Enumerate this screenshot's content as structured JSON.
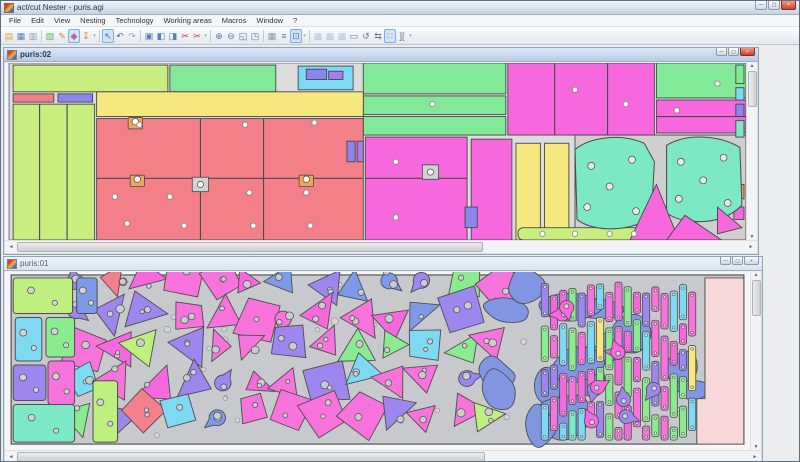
{
  "app": {
    "title": "act/cut Nester - puris.agi"
  },
  "captions": {
    "min": "—",
    "max": "▢",
    "close": "×"
  },
  "scroll": {
    "up": "▲",
    "down": "▼",
    "left": "◄",
    "right": "►"
  },
  "menu": {
    "items": [
      "File",
      "Edit",
      "View",
      "Nesting",
      "Technology",
      "Working areas",
      "Macros",
      "Window",
      "?"
    ]
  },
  "toolbar": {
    "items": [
      {
        "t": "b",
        "n": "open",
        "g": "▤",
        "c": "#d9a33c"
      },
      {
        "t": "b",
        "n": "save",
        "g": "▦",
        "c": "#5b7fb4"
      },
      {
        "t": "b",
        "n": "print",
        "g": "▥",
        "c": "#8d98a5"
      },
      {
        "t": "s"
      },
      {
        "t": "b",
        "n": "new-sheet",
        "g": "▧",
        "c": "#58b65c"
      },
      {
        "t": "b",
        "n": "edit-sheet",
        "g": "✎",
        "c": "#d98a3c"
      },
      {
        "t": "b",
        "n": "erase-tool",
        "g": "◆",
        "c": "#d0569a",
        "st": "sel"
      },
      {
        "t": "b",
        "n": "punch-tool",
        "g": "↧",
        "c": "#c8872e"
      },
      {
        "t": "g"
      },
      {
        "t": "s"
      },
      {
        "t": "b",
        "n": "select-pointer",
        "g": "↖",
        "c": "#3d6eb4",
        "st": "sel"
      },
      {
        "t": "b",
        "n": "undo",
        "g": "↶",
        "c": "#3d6eb4"
      },
      {
        "t": "b",
        "n": "redo",
        "g": "↷",
        "c": "#9aa3ad"
      },
      {
        "t": "s"
      },
      {
        "t": "b",
        "n": "copy",
        "g": "▣",
        "c": "#5b7fb4"
      },
      {
        "t": "b",
        "n": "paste",
        "g": "◧",
        "c": "#5b7fb4"
      },
      {
        "t": "b",
        "n": "paste-special",
        "g": "◨",
        "c": "#5b7fb4"
      },
      {
        "t": "b",
        "n": "cut",
        "g": "✂",
        "c": "#cc3c34"
      },
      {
        "t": "b",
        "n": "cut-multi",
        "g": "✂",
        "c": "#cc3c34"
      },
      {
        "t": "g"
      },
      {
        "t": "s"
      },
      {
        "t": "b",
        "n": "zoom-in",
        "g": "⊕",
        "c": "#4a7ab0"
      },
      {
        "t": "b",
        "n": "zoom-out",
        "g": "⊖",
        "c": "#4a7ab0"
      },
      {
        "t": "b",
        "n": "zoom-window",
        "g": "◱",
        "c": "#4a7ab0"
      },
      {
        "t": "b",
        "n": "zoom-all",
        "g": "◳",
        "c": "#4a7ab0"
      },
      {
        "t": "s"
      },
      {
        "t": "b",
        "n": "grid",
        "g": "▦",
        "c": "#8d98a5"
      },
      {
        "t": "b",
        "n": "sort-parts",
        "g": "≡",
        "c": "#4a7ab0"
      },
      {
        "t": "b",
        "n": "origin-toggle",
        "g": "⊡",
        "c": "#4a7ab0",
        "st": "sel"
      },
      {
        "t": "g"
      },
      {
        "t": "s"
      },
      {
        "t": "b",
        "n": "nest-auto",
        "g": "▩",
        "c": "#4a7ab0",
        "st": "dis"
      },
      {
        "t": "b",
        "n": "nest-block",
        "g": "▩",
        "c": "#4a7ab0",
        "st": "dis"
      },
      {
        "t": "b",
        "n": "nest-fill",
        "g": "▩",
        "c": "#4a7ab0",
        "st": "dis"
      },
      {
        "t": "b",
        "n": "sheet-outline",
        "g": "▭",
        "c": "#6a7685"
      },
      {
        "t": "b",
        "n": "rotate-part",
        "g": "↺",
        "c": "#6a7685"
      },
      {
        "t": "b",
        "n": "flip-part",
        "g": "⇆",
        "c": "#6a7685"
      },
      {
        "t": "b",
        "n": "pair-parts",
        "g": "∷",
        "c": "#e0742c",
        "st": "sel"
      },
      {
        "t": "b",
        "n": "gauge",
        "g": "][",
        "c": "#6a7685"
      },
      {
        "t": "g"
      }
    ]
  },
  "mdi": {
    "windows": [
      {
        "title": "puris:02",
        "active": true
      },
      {
        "title": "puris:01",
        "active": false
      }
    ]
  },
  "win1": {
    "palette": {
      "LG": "#c9ee80",
      "GN": "#82e998",
      "YL": "#f6e87e",
      "SM": "#f37f89",
      "MG": "#f767de",
      "CY": "#7edaf2",
      "BL": "#8a86f0",
      "AQ": "#7ce9c4",
      "OR": "#efa45a",
      "VT": "#a77df0",
      "GY": "#cfcfcf"
    },
    "sheet": [
      4,
      0,
      724,
      172
    ],
    "rects": [
      [
        8,
        2,
        152,
        26,
        "LG"
      ],
      [
        162,
        2,
        104,
        26,
        "GN"
      ],
      [
        288,
        3,
        54,
        23,
        "CY"
      ],
      [
        352,
        0,
        140,
        30,
        "GN"
      ],
      [
        352,
        32,
        140,
        18,
        "GN"
      ],
      [
        352,
        52,
        140,
        18,
        "GN"
      ],
      [
        494,
        0,
        144,
        70,
        "MG"
      ],
      [
        640,
        0,
        88,
        34,
        "GN"
      ],
      [
        640,
        36,
        88,
        32,
        "MG"
      ],
      [
        8,
        30,
        40,
        8,
        "SM"
      ],
      [
        52,
        30,
        34,
        8,
        "BL"
      ],
      [
        8,
        40,
        80,
        132,
        "LG"
      ],
      [
        90,
        28,
        262,
        24,
        "YL"
      ],
      [
        90,
        54,
        262,
        118,
        "SM"
      ],
      [
        354,
        72,
        100,
        100,
        "MG"
      ],
      [
        458,
        74,
        40,
        98,
        "MG"
      ],
      [
        502,
        78,
        24,
        94,
        "YL"
      ],
      [
        530,
        78,
        24,
        94,
        "YL"
      ],
      [
        560,
        70,
        168,
        102,
        "GY"
      ],
      [
        296,
        6,
        20,
        10,
        "BL"
      ],
      [
        318,
        8,
        14,
        8,
        "VT"
      ],
      [
        336,
        76,
        8,
        20,
        "BL"
      ],
      [
        346,
        76,
        6,
        20,
        "VT"
      ],
      [
        452,
        140,
        12,
        20,
        "BL"
      ],
      [
        718,
        2,
        8,
        18,
        "GN"
      ],
      [
        718,
        24,
        8,
        12,
        "CY"
      ],
      [
        718,
        40,
        8,
        12,
        "BL"
      ],
      [
        718,
        56,
        8,
        16,
        "AQ"
      ],
      [
        718,
        118,
        8,
        14,
        "OR"
      ],
      [
        716,
        140,
        10,
        12,
        "MG"
      ]
    ],
    "bar": [
      504,
      160,
      130,
      12,
      "LG"
    ],
    "lines": [
      [
        34,
        40,
        34,
        172
      ],
      [
        61,
        40,
        61,
        172
      ],
      [
        192,
        54,
        192,
        172
      ],
      [
        254,
        54,
        254,
        172
      ],
      [
        90,
        112,
        352,
        112
      ],
      [
        354,
        112,
        454,
        112
      ],
      [
        540,
        0,
        540,
        70
      ],
      [
        592,
        0,
        592,
        70
      ],
      [
        640,
        52,
        728,
        52
      ]
    ],
    "circles": [
      [
        132,
        60
      ],
      [
        236,
        60
      ],
      [
        304,
        58
      ],
      [
        108,
        130
      ],
      [
        162,
        130
      ],
      [
        240,
        126
      ],
      [
        296,
        126
      ],
      [
        120,
        156
      ],
      [
        176,
        158
      ],
      [
        244,
        158
      ],
      [
        300,
        158
      ],
      [
        384,
        96
      ],
      [
        384,
        150
      ],
      [
        420,
        40
      ],
      [
        560,
        26
      ],
      [
        610,
        40
      ],
      [
        660,
        46
      ],
      [
        700,
        20
      ],
      [
        528,
        166
      ],
      [
        560,
        166
      ],
      [
        594,
        166
      ],
      [
        618,
        166
      ]
    ],
    "clamps": [
      [
        128,
        58
      ],
      [
        130,
        114
      ],
      [
        296,
        114
      ]
    ],
    "plates": [
      [
        192,
        118
      ],
      [
        418,
        106
      ]
    ],
    "blobs": [
      {
        "d": "M560,84 C575,72 605,68 628,78 L638,96 L635,150 C615,164 578,165 562,152 Z",
        "holes": [
          [
            576,
            100
          ],
          [
            616,
            94
          ],
          [
            572,
            140
          ],
          [
            620,
            144
          ],
          [
            594,
            120
          ]
        ]
      },
      {
        "d": "M650,80 C670,68 702,70 722,82 L724,138 C706,158 668,158 650,146 Z",
        "holes": [
          [
            664,
            96
          ],
          [
            706,
            92
          ],
          [
            662,
            132
          ],
          [
            710,
            136
          ],
          [
            686,
            114
          ]
        ]
      }
    ],
    "wedges": [
      [
        640,
        118,
        662,
        172,
        614,
        172
      ],
      [
        668,
        148,
        704,
        172,
        650,
        172
      ],
      [
        700,
        140,
        724,
        160,
        700,
        166
      ]
    ]
  },
  "win2": {
    "palette": {
      "PN": "#f973dc",
      "VT": "#9d86ee",
      "BL": "#7d9ae8",
      "CF": "#8096e2",
      "GN": "#8aec8e",
      "LG": "#bdf07e",
      "CY": "#7edaf2",
      "AQ": "#7ceac6",
      "MG": "#f767de",
      "YL": "#f6e87e",
      "OR": "#f29a5c",
      "SM": "#f3808b",
      "PK": "#f8d7da",
      "SH": "#c8c9cc"
    },
    "seed": 20,
    "sheet": [
      6,
      3,
      716,
      171
    ],
    "left_shapes": [
      [
        8,
        6,
        58,
        36,
        "LG"
      ],
      [
        10,
        46,
        26,
        44,
        "CY"
      ],
      [
        40,
        46,
        28,
        40,
        "GN"
      ],
      [
        8,
        94,
        32,
        36,
        "VT"
      ],
      [
        42,
        90,
        26,
        44,
        "PN"
      ],
      [
        8,
        134,
        60,
        38,
        "AQ"
      ],
      [
        70,
        6,
        20,
        36,
        "BL"
      ],
      [
        86,
        110,
        24,
        62,
        "LG"
      ]
    ],
    "mid": {
      "x": 72,
      "y": 10,
      "cols": 13,
      "rows": 5,
      "dx": 34,
      "dy": 33,
      "weights": [
        [
          "PN",
          42
        ],
        [
          "VT",
          18
        ],
        [
          "BL",
          14
        ],
        [
          "MG",
          8
        ],
        [
          "GN",
          7
        ],
        [
          "CY",
          6
        ],
        [
          "LG",
          3
        ],
        [
          "SM",
          2
        ]
      ]
    },
    "blue": {
      "x": 474,
      "w": 200,
      "count": 16
    },
    "strips": {
      "x": 524,
      "cols": 17,
      "dx": 9,
      "weights": [
        [
          "PN",
          30
        ],
        [
          "GN",
          22
        ],
        [
          "CY",
          16
        ],
        [
          "VT",
          14
        ],
        [
          "MG",
          10
        ],
        [
          "AQ",
          5
        ],
        [
          "YL",
          3
        ]
      ]
    },
    "tears": 10,
    "dots": 45,
    "pink_poly": "684,6 722,6 722,174 676,174 676,128 684,128"
  }
}
